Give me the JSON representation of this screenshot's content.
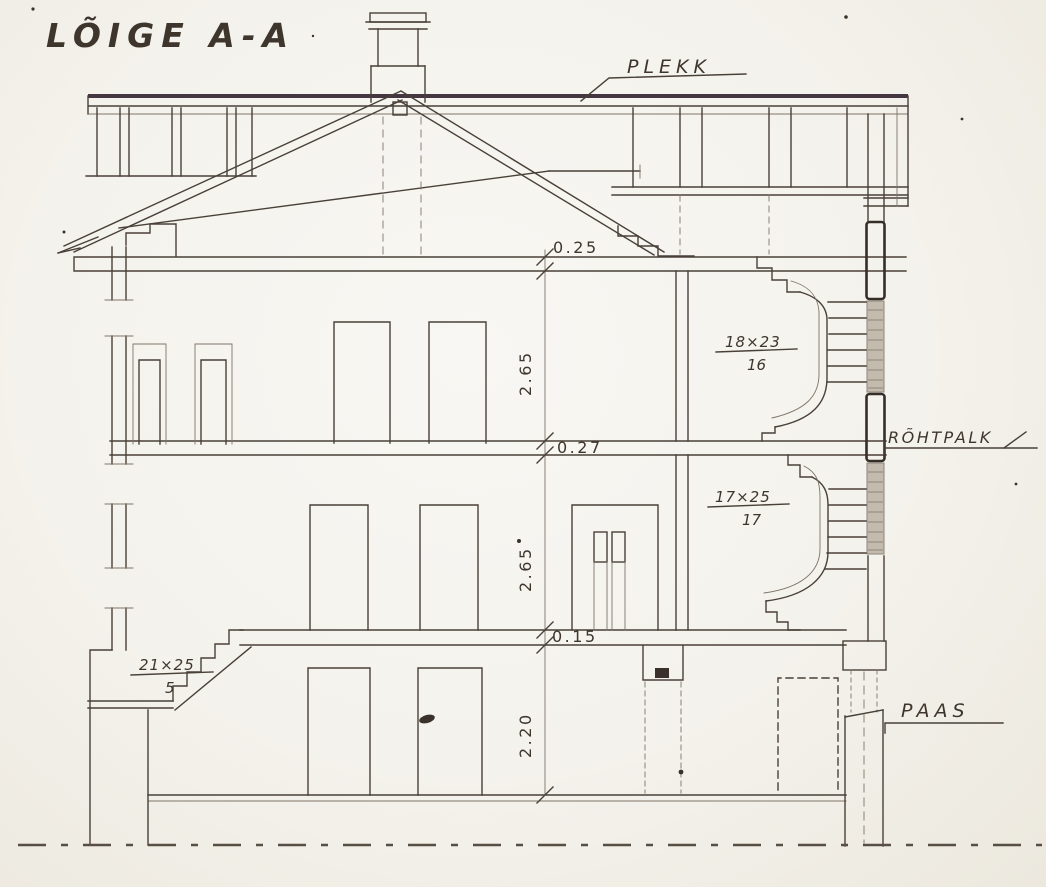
{
  "drawing": {
    "title": "LÕIGE A-A",
    "labels": {
      "roof_material": "PLEKK",
      "wall_material": "RÕHTPALK",
      "foundation_material": "PAAS"
    },
    "dimensions": {
      "attic_slab_thickness": "0.25",
      "upper_floor_height": "2.65",
      "middle_slab_thickness": "0.27",
      "lower_floor_height": "2.65",
      "ground_slab_thickness": "0.15",
      "basement_height": "2.20"
    },
    "stairs": {
      "upper_flight": {
        "step_size": "18×23",
        "step_count": "16"
      },
      "lower_flight": {
        "step_size": "17×25",
        "step_count": "17"
      },
      "entry_flight": {
        "step_size": "21×25",
        "step_count": "5"
      }
    },
    "colors": {
      "ink": "#494038",
      "paper": "#f5f3ed"
    }
  }
}
